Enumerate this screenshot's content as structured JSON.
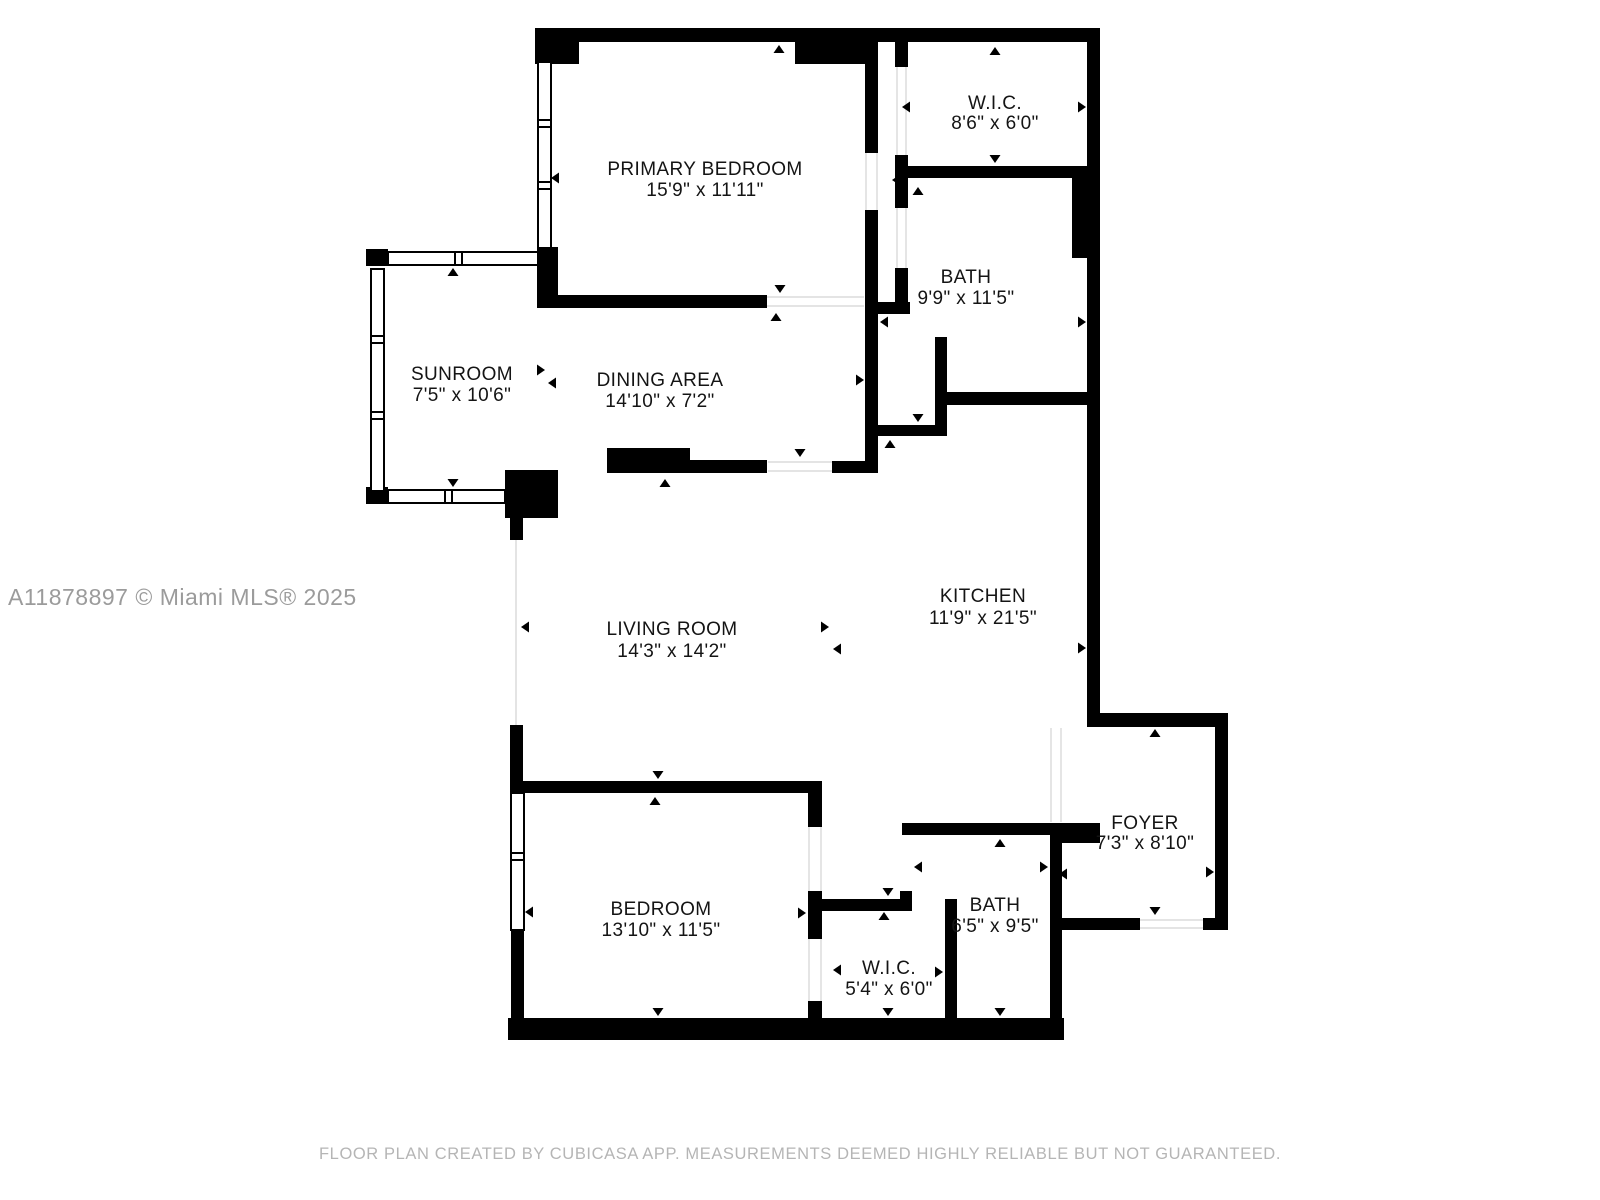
{
  "page": {
    "background": "#ffffff",
    "wall_color": "#000000",
    "label_color": "#141414"
  },
  "watermark": {
    "text": "A11878897 © Miami MLS® 2025",
    "color": "#9b9b9b"
  },
  "footer": {
    "text": "FLOOR PLAN CREATED BY CUBICASA APP. MEASUREMENTS DEEMED HIGHLY RELIABLE BUT NOT GUARANTEED.",
    "color": "#b5b5b5"
  },
  "rooms": [
    {
      "name": "PRIMARY BEDROOM",
      "dims": "15'9\" x 11'11\""
    },
    {
      "name": "W.I.C.",
      "dims": "8'6\" x 6'0\""
    },
    {
      "name": "BATH",
      "dims": "9'9\" x 11'5\""
    },
    {
      "name": "SUNROOM",
      "dims": "7'5\" x 10'6\""
    },
    {
      "name": "DINING AREA",
      "dims": "14'10\" x 7'2\""
    },
    {
      "name": "LIVING ROOM",
      "dims": "14'3\" x 14'2\""
    },
    {
      "name": "KITCHEN",
      "dims": "11'9\" x 21'5\""
    },
    {
      "name": "FOYER",
      "dims": "7'3\" x 8'10\""
    },
    {
      "name": "BEDROOM",
      "dims": "13'10\" x 11'5\""
    },
    {
      "name": "W.I.C.",
      "dims": "5'4\" x 6'0\""
    },
    {
      "name": "BATH",
      "dims": "6'5\" x 9'5\""
    }
  ]
}
